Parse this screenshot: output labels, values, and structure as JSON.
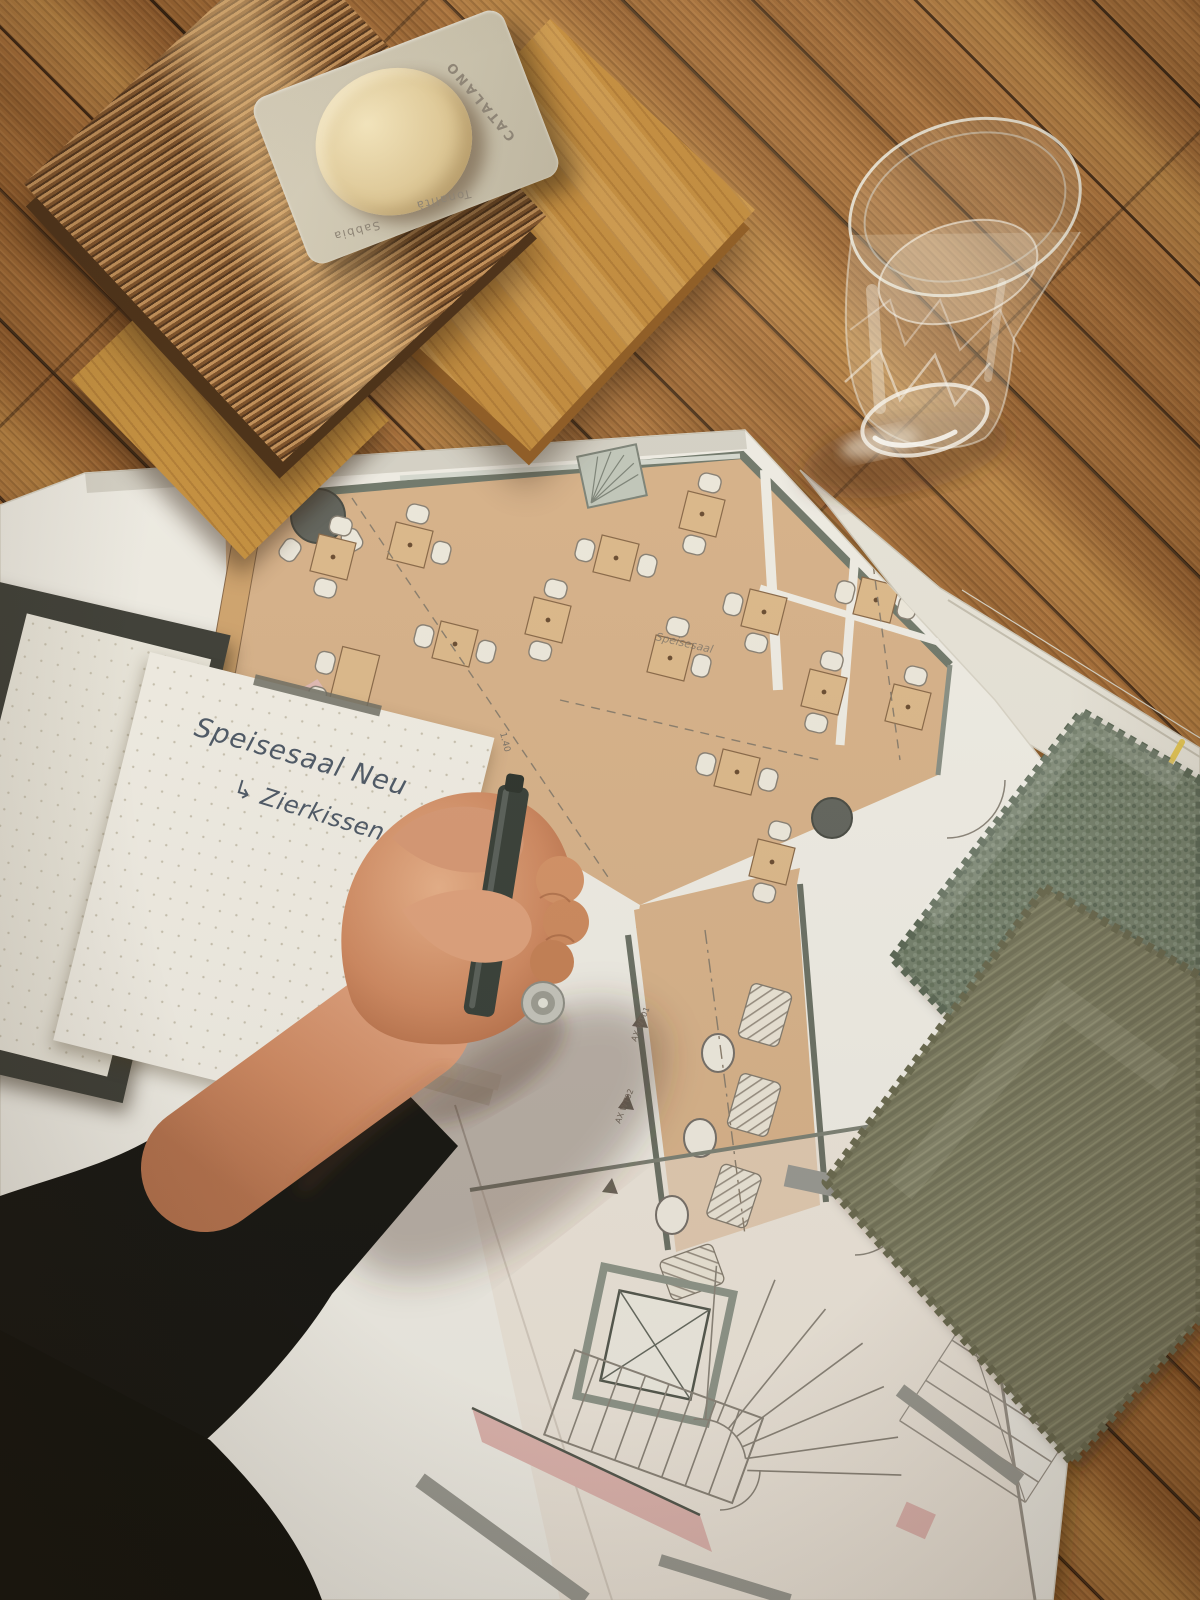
{
  "scene": {
    "type": "photograph",
    "subject": "interior-design moodboard: floor plan, wood samples, fabric swatches, notebook and hand with pen on oak floor"
  },
  "material_card": {
    "brand": "CATALANO",
    "finish_label": "Tonalità",
    "color_label": "Sabbia",
    "card_color": "#cfc8b5",
    "dome_color": "#e7d7ae"
  },
  "wood_samples": {
    "count": 3,
    "tones": [
      "#c28c3e",
      "#7d5129",
      "#c6913f"
    ]
  },
  "water_glass": {
    "content": "water",
    "style": "faceted tumbler"
  },
  "notebook": {
    "line1": "Speisesaal Neu",
    "line2": "↳ Zierkissen 207,208",
    "ink_color": "#4e5a68",
    "paper": "dot grid"
  },
  "floor_plan": {
    "room_label": "Speisesaal",
    "annotations": [
      "1.40",
      "5.04",
      "AX WT01",
      "AX WT02"
    ],
    "room_fill": "#d9b48c",
    "wall_color": "#6c7266",
    "accent_pink": "#dfb6b0",
    "highlight_color": "#e8c84a"
  },
  "fabric_swatches": [
    {
      "name": "sage bouclé",
      "color": "#76826e"
    },
    {
      "name": "olive twill",
      "color": "#7d7d62"
    }
  ],
  "hand": {
    "holding": "pen",
    "pen_color": "#39413a"
  }
}
